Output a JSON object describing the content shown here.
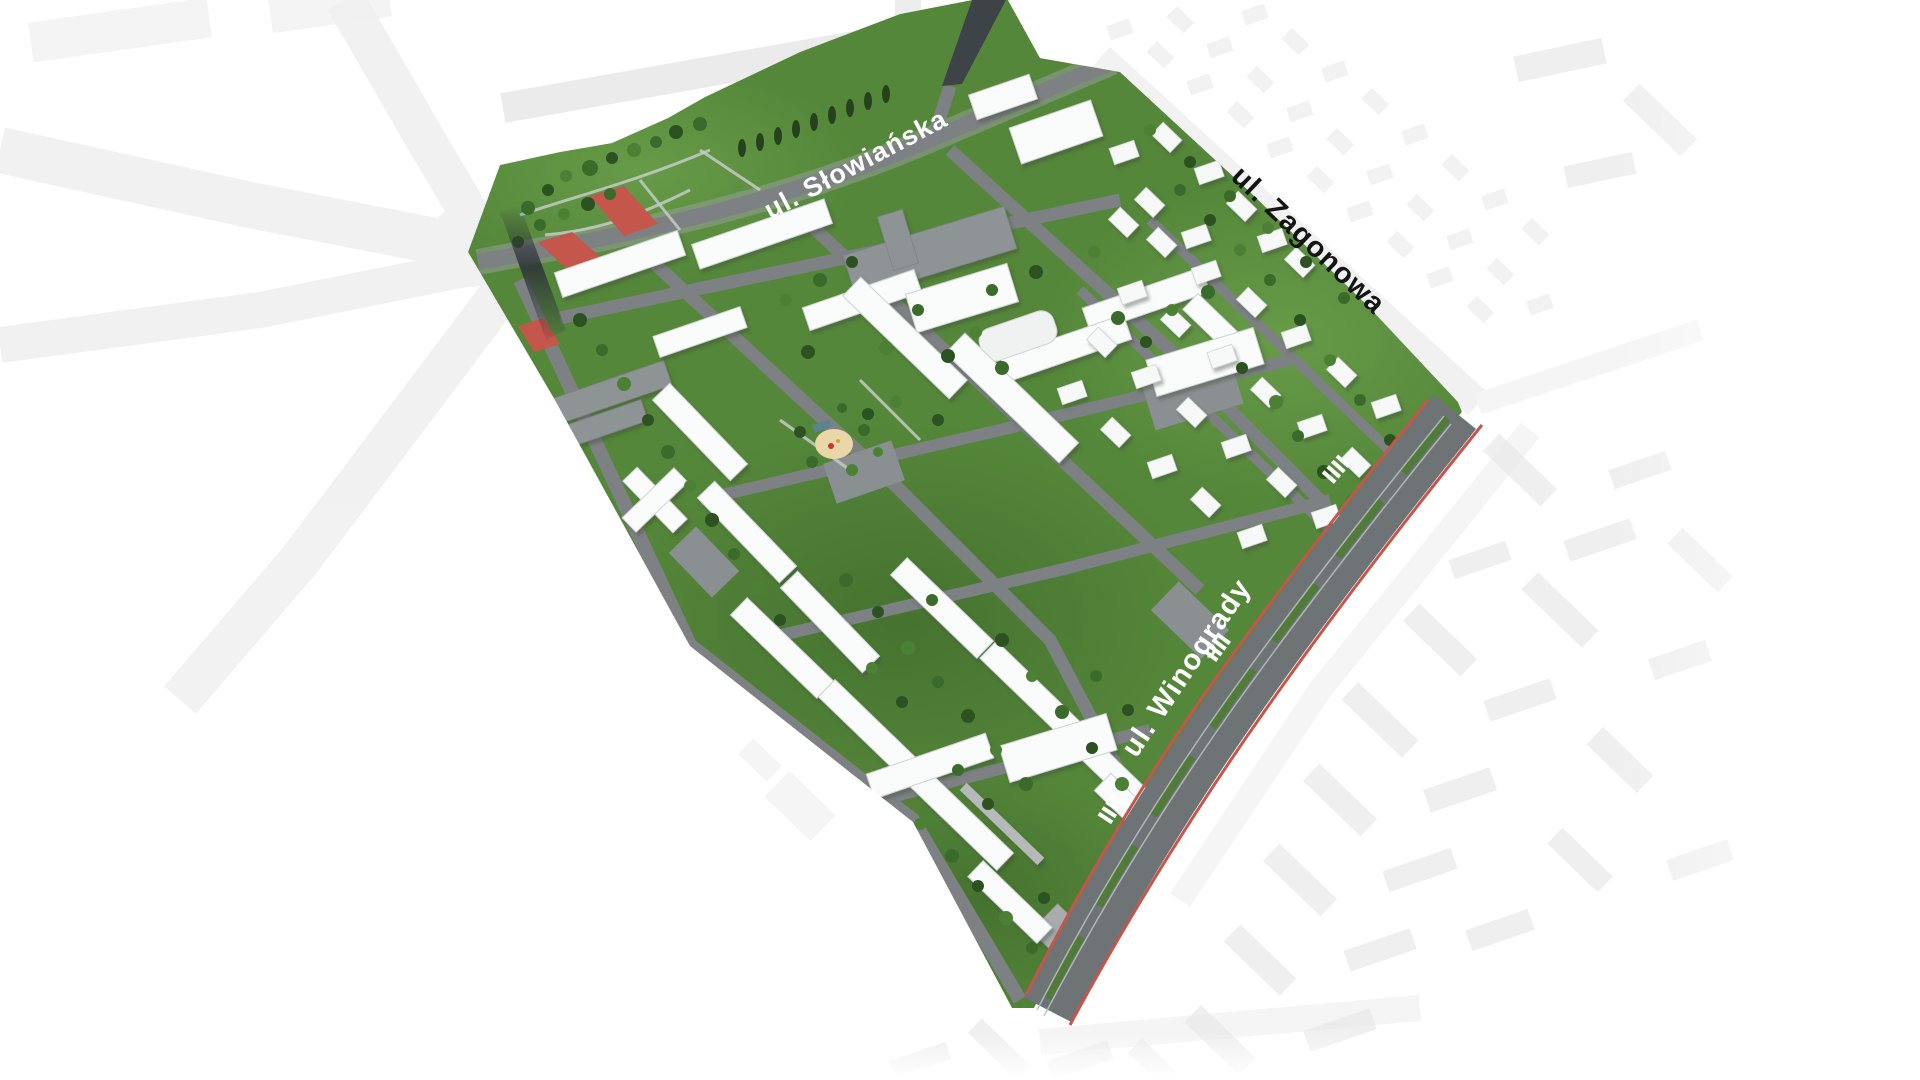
{
  "scene": {
    "type": "aerial-masterplan-render",
    "district": "residential estate bounded by three streets"
  },
  "streets": {
    "slowianska": {
      "label": "ul. Słowiańska"
    },
    "zagonowa": {
      "label": "ul. Zagonowa"
    },
    "winogrady": {
      "label": "ul. Winogrady"
    }
  },
  "palette": {
    "background": "#ffffff",
    "lawn": "#55873a",
    "lawn_light": "#69994b",
    "lawn_dark": "#3f6a2b",
    "tree_dark": "#2c5222",
    "road_gray": "#7d8184",
    "building_white": "#fafbfb",
    "building_gray": "#8e9395",
    "context_gray": "#ececec",
    "asphalt_dark": "#3d4347",
    "accent_red": "#c4564c",
    "playground_sand": "#ead7a9",
    "winogrady_asphalt": "#6e7376",
    "label_light": "#ffffff",
    "label_dark": "#141414"
  }
}
